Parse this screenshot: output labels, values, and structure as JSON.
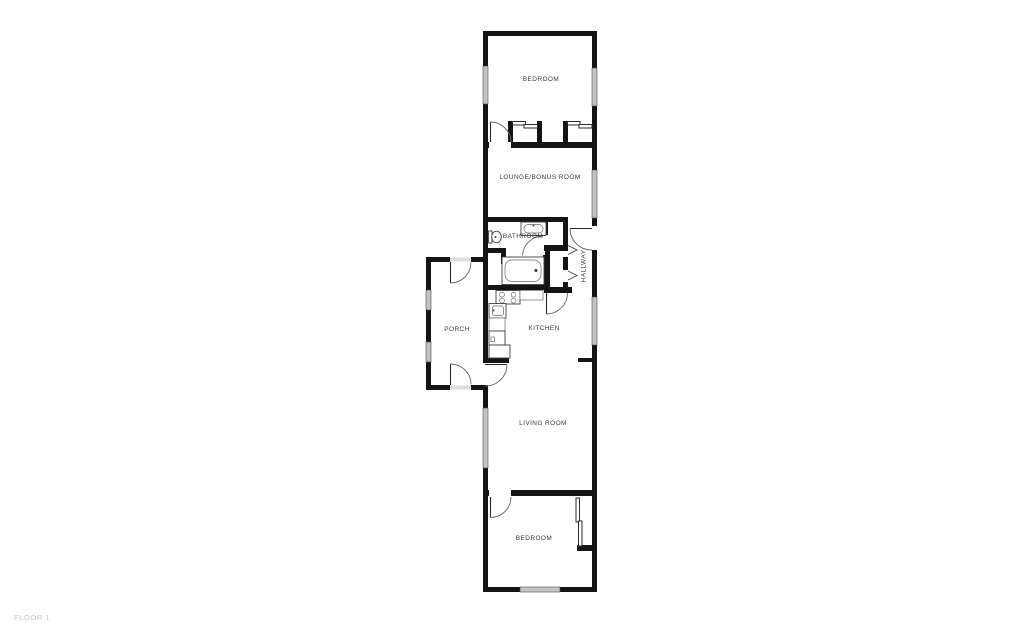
{
  "floor_label": "FLOOR 1",
  "rooms": {
    "bedroom_top": {
      "label": "BEDROOM"
    },
    "lounge": {
      "label": "LOUNGE/BONUS ROOM"
    },
    "bathroom": {
      "label": "BATHROOM"
    },
    "hallway": {
      "label": "HALLWAY"
    },
    "porch": {
      "label": "PORCH"
    },
    "kitchen": {
      "label": "KITCHEN"
    },
    "living_room": {
      "label": "LIVING ROOM"
    },
    "bedroom_bottom": {
      "label": "BEDROOM"
    }
  },
  "colors": {
    "background": "#ffffff",
    "wall": "#141414",
    "window_glass": "#c2c2c2",
    "fixture_line": "#4a4a4a",
    "room_label": "#3c3c3c",
    "floor_label": "#c6c6c6"
  }
}
